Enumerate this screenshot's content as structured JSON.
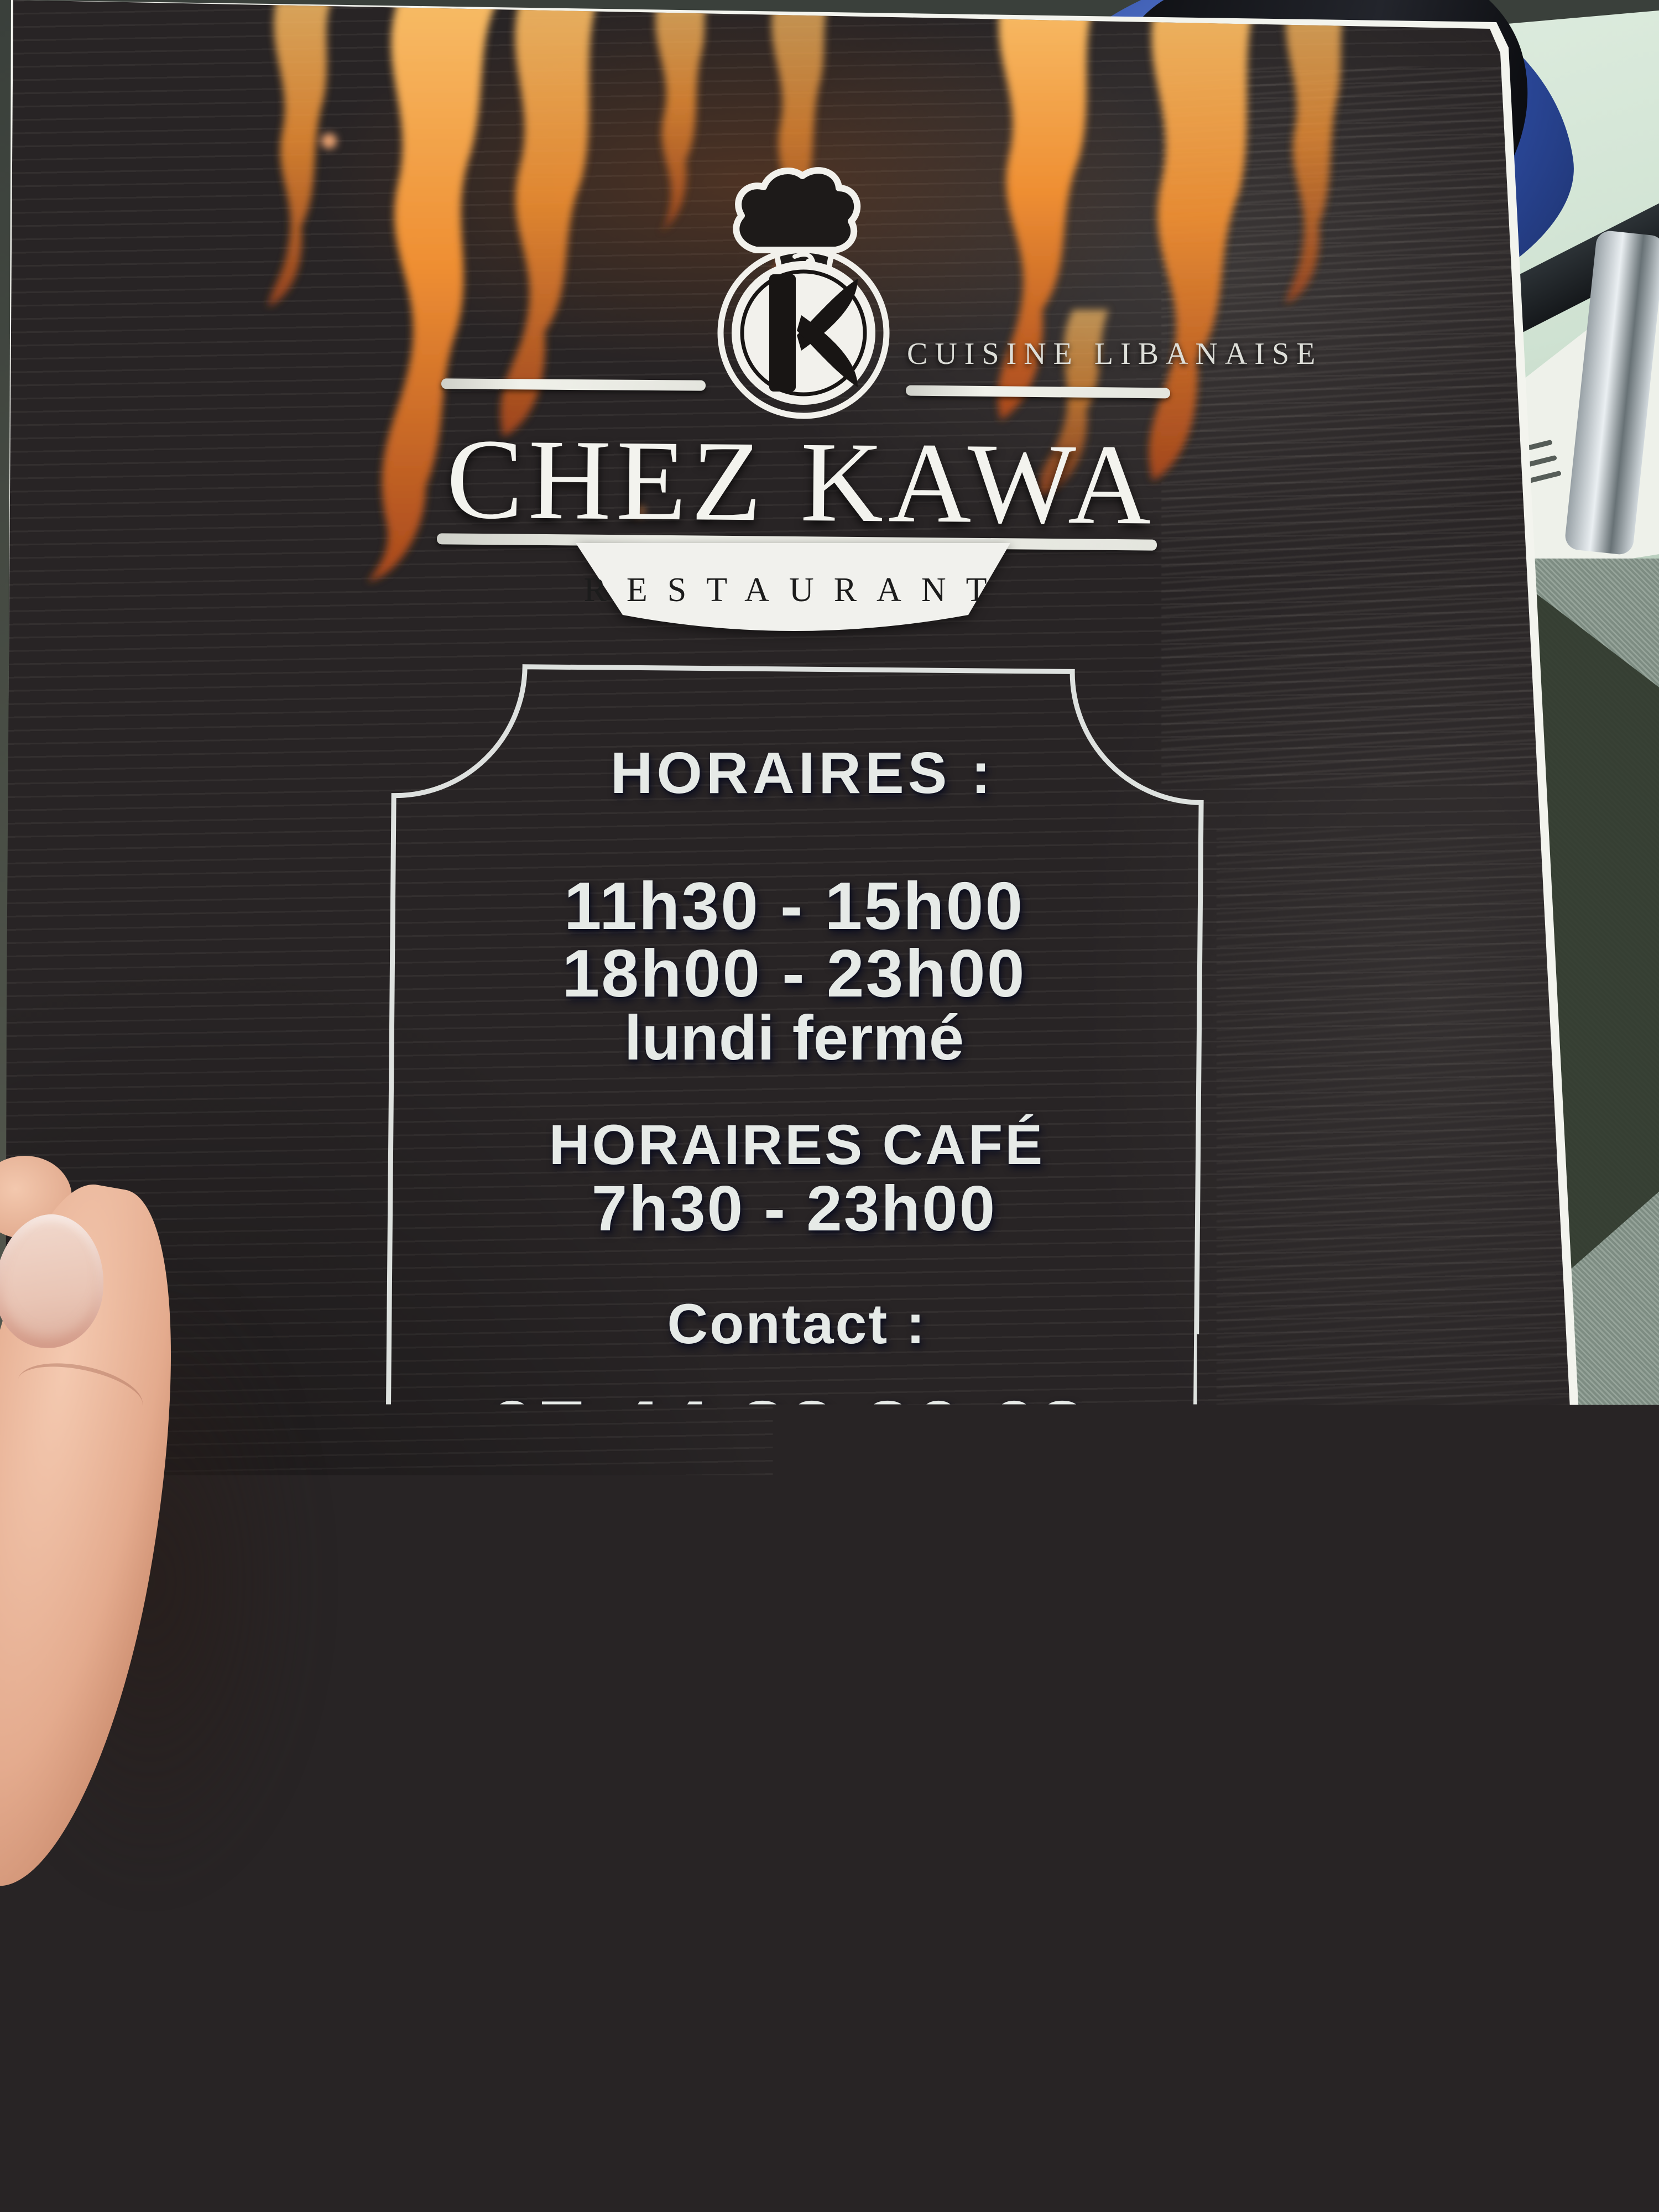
{
  "brand": {
    "logo_icon": "chef-hat-k-monogram",
    "tagline": "CUISINE LIBANAISE",
    "name": "CHEZ KAWA",
    "descriptor": "RESTAURANT"
  },
  "hours": {
    "heading": "HORAIRES :",
    "lunch": "11h30 - 15h00",
    "dinner": "18h00 - 23h00",
    "closed_note": "lundi fermé"
  },
  "cafe_hours": {
    "heading": "HORAIRES CAFÉ",
    "range": "7h30 - 23h00"
  },
  "contact": {
    "heading": "Contact :",
    "phone": "07 44 82 86 68",
    "address_line1": "4 rue de la rosselle",
    "address_line2": "FREYMING-MERLEBACH 57800"
  },
  "watermark_icon": "chef-hat-k-monogram-watermark",
  "colors": {
    "menu_background": "#282425",
    "text": "#e6eae7",
    "flame_orange": "#ef8f33",
    "flame_deep": "#b8541f",
    "banner_white": "#f2f2ef",
    "banner_text": "#1c1c1c",
    "watermark_taupe": "#8f7d7c",
    "table_green": "#cfe2d2",
    "carpet_green": "#8a9a8f",
    "fabric_blue": "#2c4a9e",
    "wood_brown": "#b68f5f",
    "skin": "#e4ab8e"
  }
}
